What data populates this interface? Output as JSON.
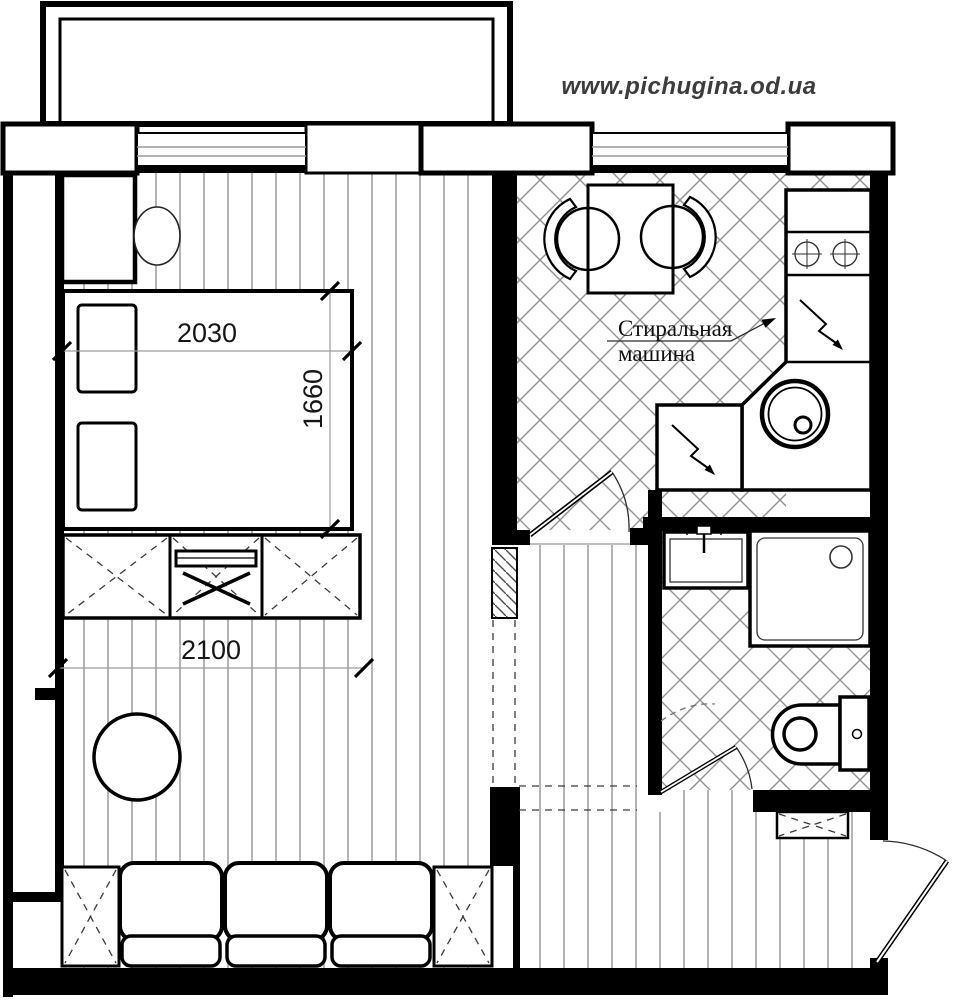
{
  "page": {
    "watermark": "www.pichugina.od.ua"
  },
  "plan": {
    "type": "apartment-floor-plan",
    "labels": {
      "washing_machine_line1": "Стиральная",
      "washing_machine_line2": "машина"
    },
    "dimensions_mm": {
      "bed_length": "2030",
      "bed_width": "1660",
      "cabinet_wall_width": "2100"
    },
    "colors": {
      "line": "#000000",
      "wood_stripe": "#b4b4b4",
      "tile_line": "#8f8f8f",
      "dimension_line": "#9c9c9c",
      "watermark_text": "#3c3c3c"
    },
    "fixtures": [
      "balcony",
      "window",
      "bed",
      "pillows",
      "wardrobe",
      "chair",
      "tv",
      "tv-cabinet",
      "round-table",
      "sofa",
      "side-table",
      "kitchen-table",
      "kitchen-chair",
      "cooktop",
      "kitchen-counter",
      "kitchen-sink",
      "washing-machine",
      "refrigerator",
      "bathroom-sink",
      "shower-cabin",
      "toilet",
      "shoe-cabinet",
      "entry-door",
      "kitchen-door",
      "bathroom-door"
    ]
  }
}
